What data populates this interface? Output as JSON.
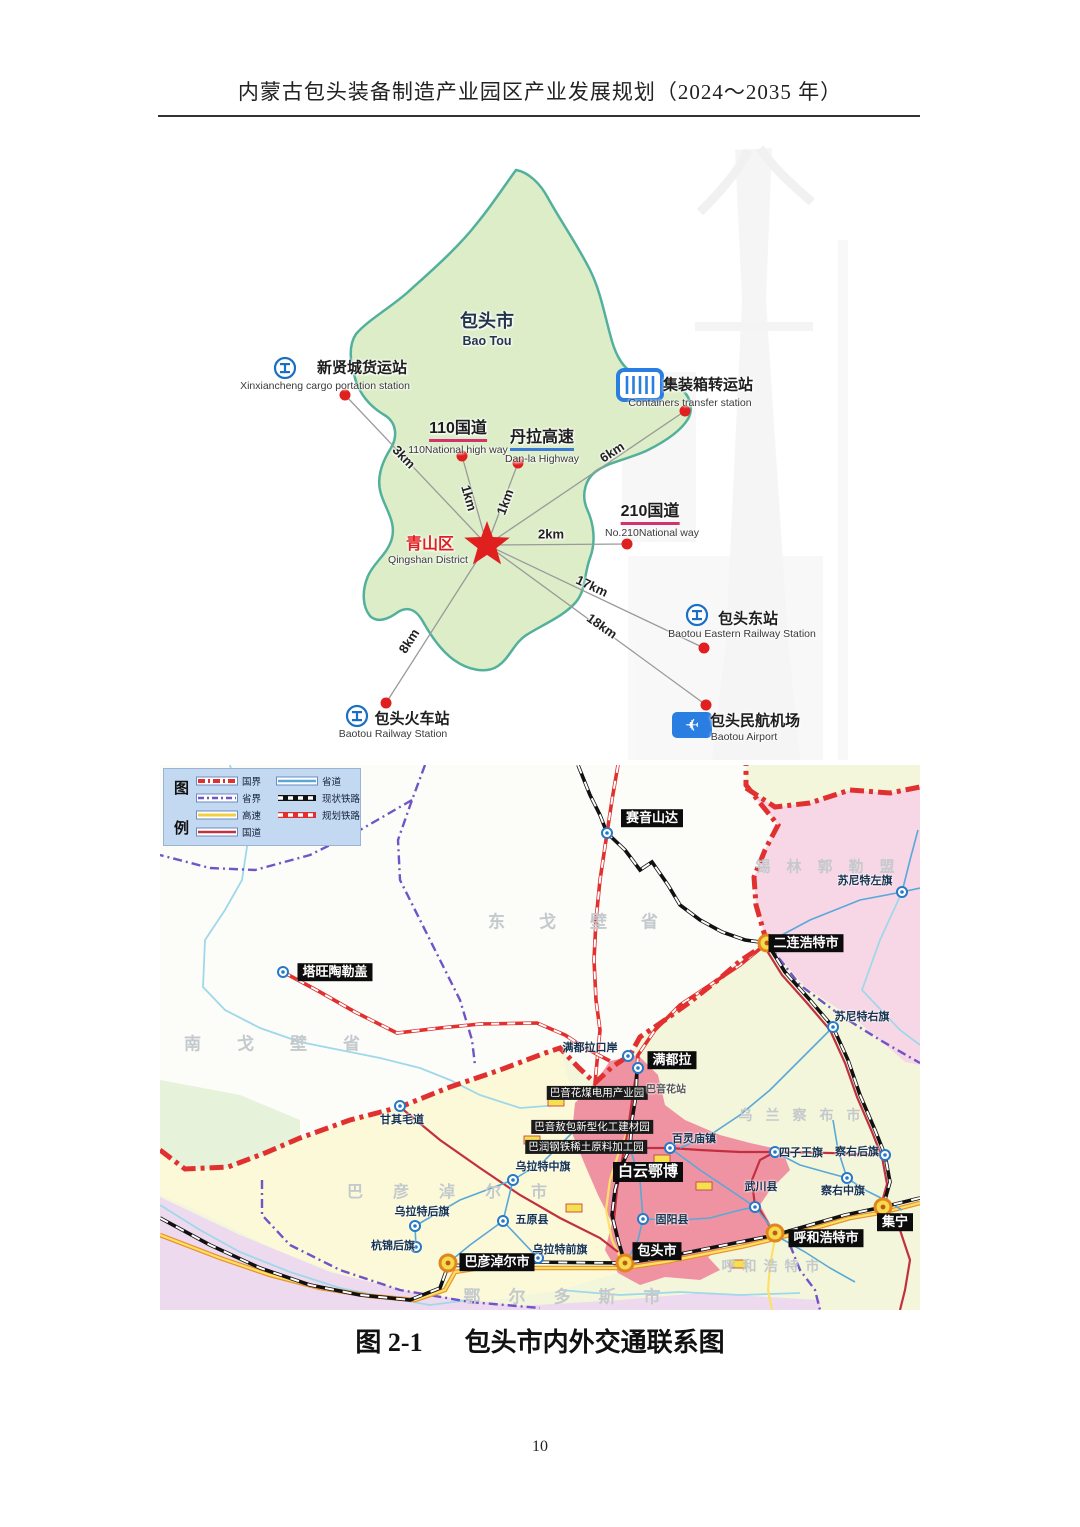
{
  "header": {
    "title": "内蒙古包头装备制造产业园区产业发展规划（2024～2035 年）"
  },
  "footer": {
    "page_number": "10"
  },
  "caption": {
    "figure_no": "图 2-1",
    "title": "包头市内外交通联系图"
  },
  "city_map": {
    "city": {
      "zh": "包头市",
      "en": "Bao Tou"
    },
    "district": {
      "zh": "青山区",
      "en": "Qingshan District"
    },
    "sites": {
      "cargo": {
        "zh": "新贤城货运站",
        "en": "Xinxiancheng cargo portation station",
        "distance": "3km"
      },
      "container": {
        "zh": "集装箱转运站",
        "en": "Containers transfer station",
        "distance": "6km"
      },
      "g110": {
        "zh": "110国道",
        "en": "110National high way",
        "distance": "1km"
      },
      "danla": {
        "zh": "丹拉高速",
        "en": "Dan-la Highway",
        "distance": "1km"
      },
      "g210": {
        "zh": "210国道",
        "en": "No.210National way",
        "distance": "2km"
      },
      "east_station": {
        "zh": "包头东站",
        "en": "Baotou Eastern Railway Station",
        "distance": "17km"
      },
      "airport": {
        "zh": "包头民航机场",
        "en": "Baotou Airport",
        "distance": "18km"
      },
      "rail_station": {
        "zh": "包头火车站",
        "en": "Baotou Railway Station",
        "distance": "8km"
      }
    }
  },
  "regional_map": {
    "legend": {
      "title_chars": [
        "图",
        "例"
      ],
      "left": [
        {
          "label": "国界"
        },
        {
          "label": "省界"
        },
        {
          "label": "高速"
        },
        {
          "label": "国道"
        }
      ],
      "right": [
        {
          "label": "省道"
        },
        {
          "label": "现状铁路"
        },
        {
          "label": "规划铁路"
        }
      ]
    },
    "regions": {
      "dong_gobi": "东戈壁省",
      "nan_gobi": "南戈壁省",
      "xilingol": "锡林郭勒盟",
      "ulanqab": "乌兰察布市",
      "bayannur": "巴彦淖尔市",
      "ordos": "鄂尔多斯市",
      "hohhot_region": "呼和浩特市"
    },
    "hubs": {
      "erenhot": "二连浩特市",
      "bayannur": "巴彦淖尔市",
      "baotou": "包头市",
      "hohhot": "呼和浩特市",
      "jining": "集宁"
    },
    "boxed": {
      "sainshand": "赛音山达",
      "tavantolgoi": "塔旺陶勒盖",
      "mandula": "满都拉",
      "baiyunebo": "白云鄂博"
    },
    "parks": {
      "bayinhua": "巴音花煤电用产业园",
      "bayinaobao": "巴音敖包新型化工建材园",
      "barun": "巴润钢铁稀土原料加工园"
    },
    "towns": {
      "sonid_left": "苏尼特左旗",
      "sonid_right": "苏尼特右旗",
      "mandula_port": "满都拉口岸",
      "bayinhua_station": "巴音花站",
      "ganqimaodao": "甘其毛道",
      "bailingmiao": "百灵庙镇",
      "siziwang": "四子王旗",
      "chayou_rear": "察右后旗",
      "chayou_mid": "察右中旗",
      "wuchuan": "武川县",
      "guyang": "固阳县",
      "urad_mid": "乌拉特中旗",
      "urad_rear": "乌拉特后旗",
      "hangjin_rear": "杭锦后旗",
      "wuyuan": "五原县",
      "urad_front": "乌拉特前旗"
    }
  },
  "colors": {
    "map_green": "#dcedc8",
    "map_green_border": "#52b09c",
    "accent_red": "#e01f1f",
    "rail_blue": "#1a6fc4",
    "legend_bg": "#c3d9f1",
    "pink_region": "#f7d7e6",
    "red_corridor": "#ef93a2",
    "yellow_region": "#fbf9d8",
    "base_region": "#f3f6da",
    "lavender_region": "#eedaee",
    "west_green": "#e6f2da",
    "border_red": "#e03030",
    "province_purple": "#6f55c8",
    "expressway_orange": "#e8912c",
    "expressway_yellow": "#ffe066",
    "national_road_red": "#c23040",
    "province_road_blue": "#5aa8d8",
    "river_blue": "#9fd8ea",
    "gray_label": "#c3c9cc"
  }
}
